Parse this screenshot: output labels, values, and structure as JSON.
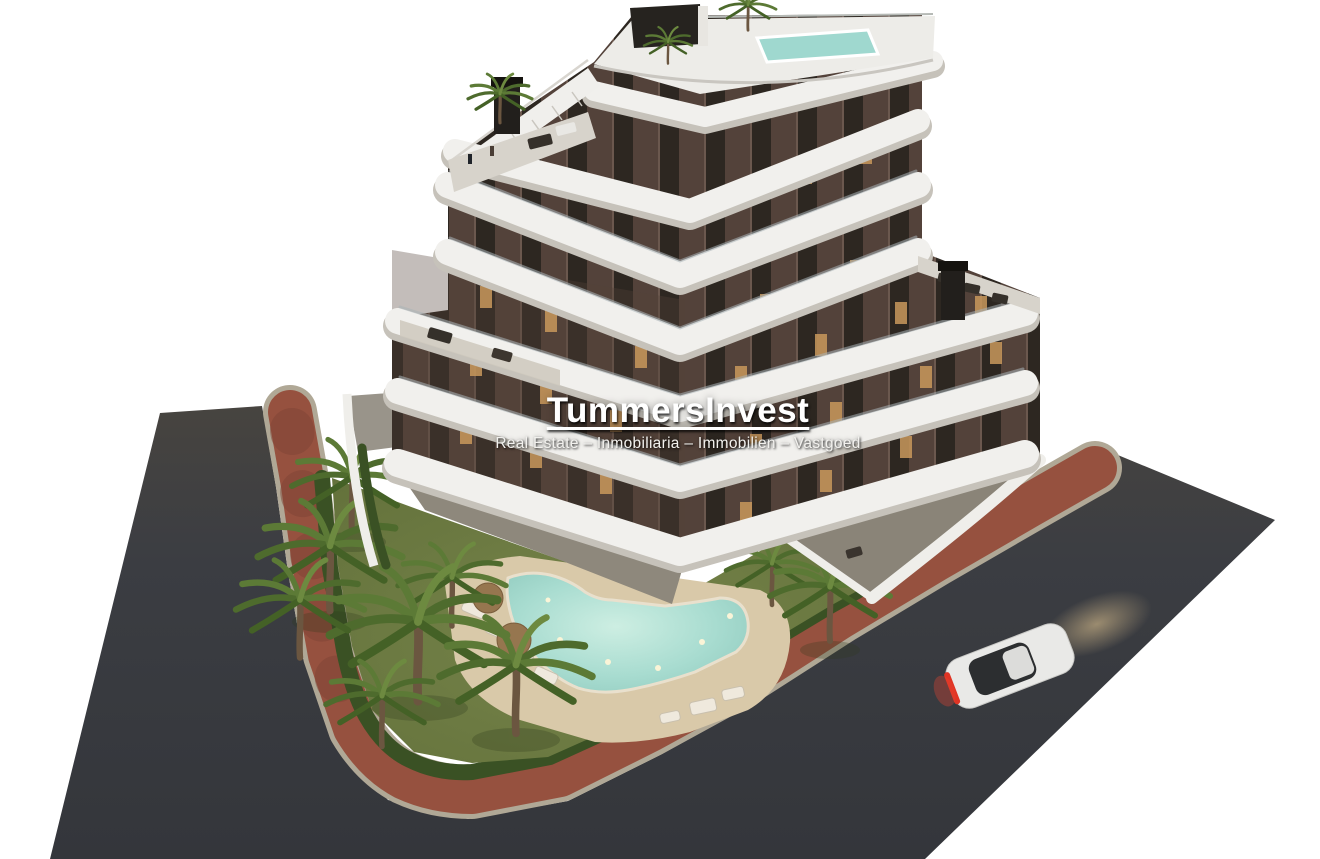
{
  "watermark": {
    "title": "TummersInvest",
    "subtitle": "Real Estate – Inmobiliaria – Immobilien – Vastgoed"
  },
  "scene": {
    "type": "architectural-3d-render",
    "setting": "Aerial dusk view of a new-build apartment complex",
    "building": "Seven-storey stepped apartment building, dark brown facades with tall window strips, curved white balcony bands on every floor, rooftop terrace with plunge pool and staircase",
    "garden": "Landscaped communal garden with lawn, free-form swimming pool with underwater lights, sandy deck, sun loungers, parasols and palm trees, hedge along the boundary",
    "surroundings": "Red paved promenade and dark asphalt road wrapping around the plot, white sports car with headlights on driving along the road",
    "vehicle": "white car"
  },
  "palette": {
    "background": "#ffffff",
    "asphalt": "#3b3d42",
    "brick_path": "#96513f",
    "curb": "#b0a896",
    "lawn": "#6a7740",
    "hedge": "#3a5124",
    "pool_water": "#9fd6c9",
    "pool_water_light": "#cdeee2",
    "sand_deck": "#d9c9a9",
    "facade_brown": "#53423a",
    "window_dark": "#2d2721",
    "window_lit": "#c9985c",
    "balcony_white": "#f1f0ed",
    "terrace_grey": "#8e887c",
    "palm_green": "#5c7a36",
    "car_white": "#e9e9e7",
    "taillight_red": "#e03424"
  }
}
